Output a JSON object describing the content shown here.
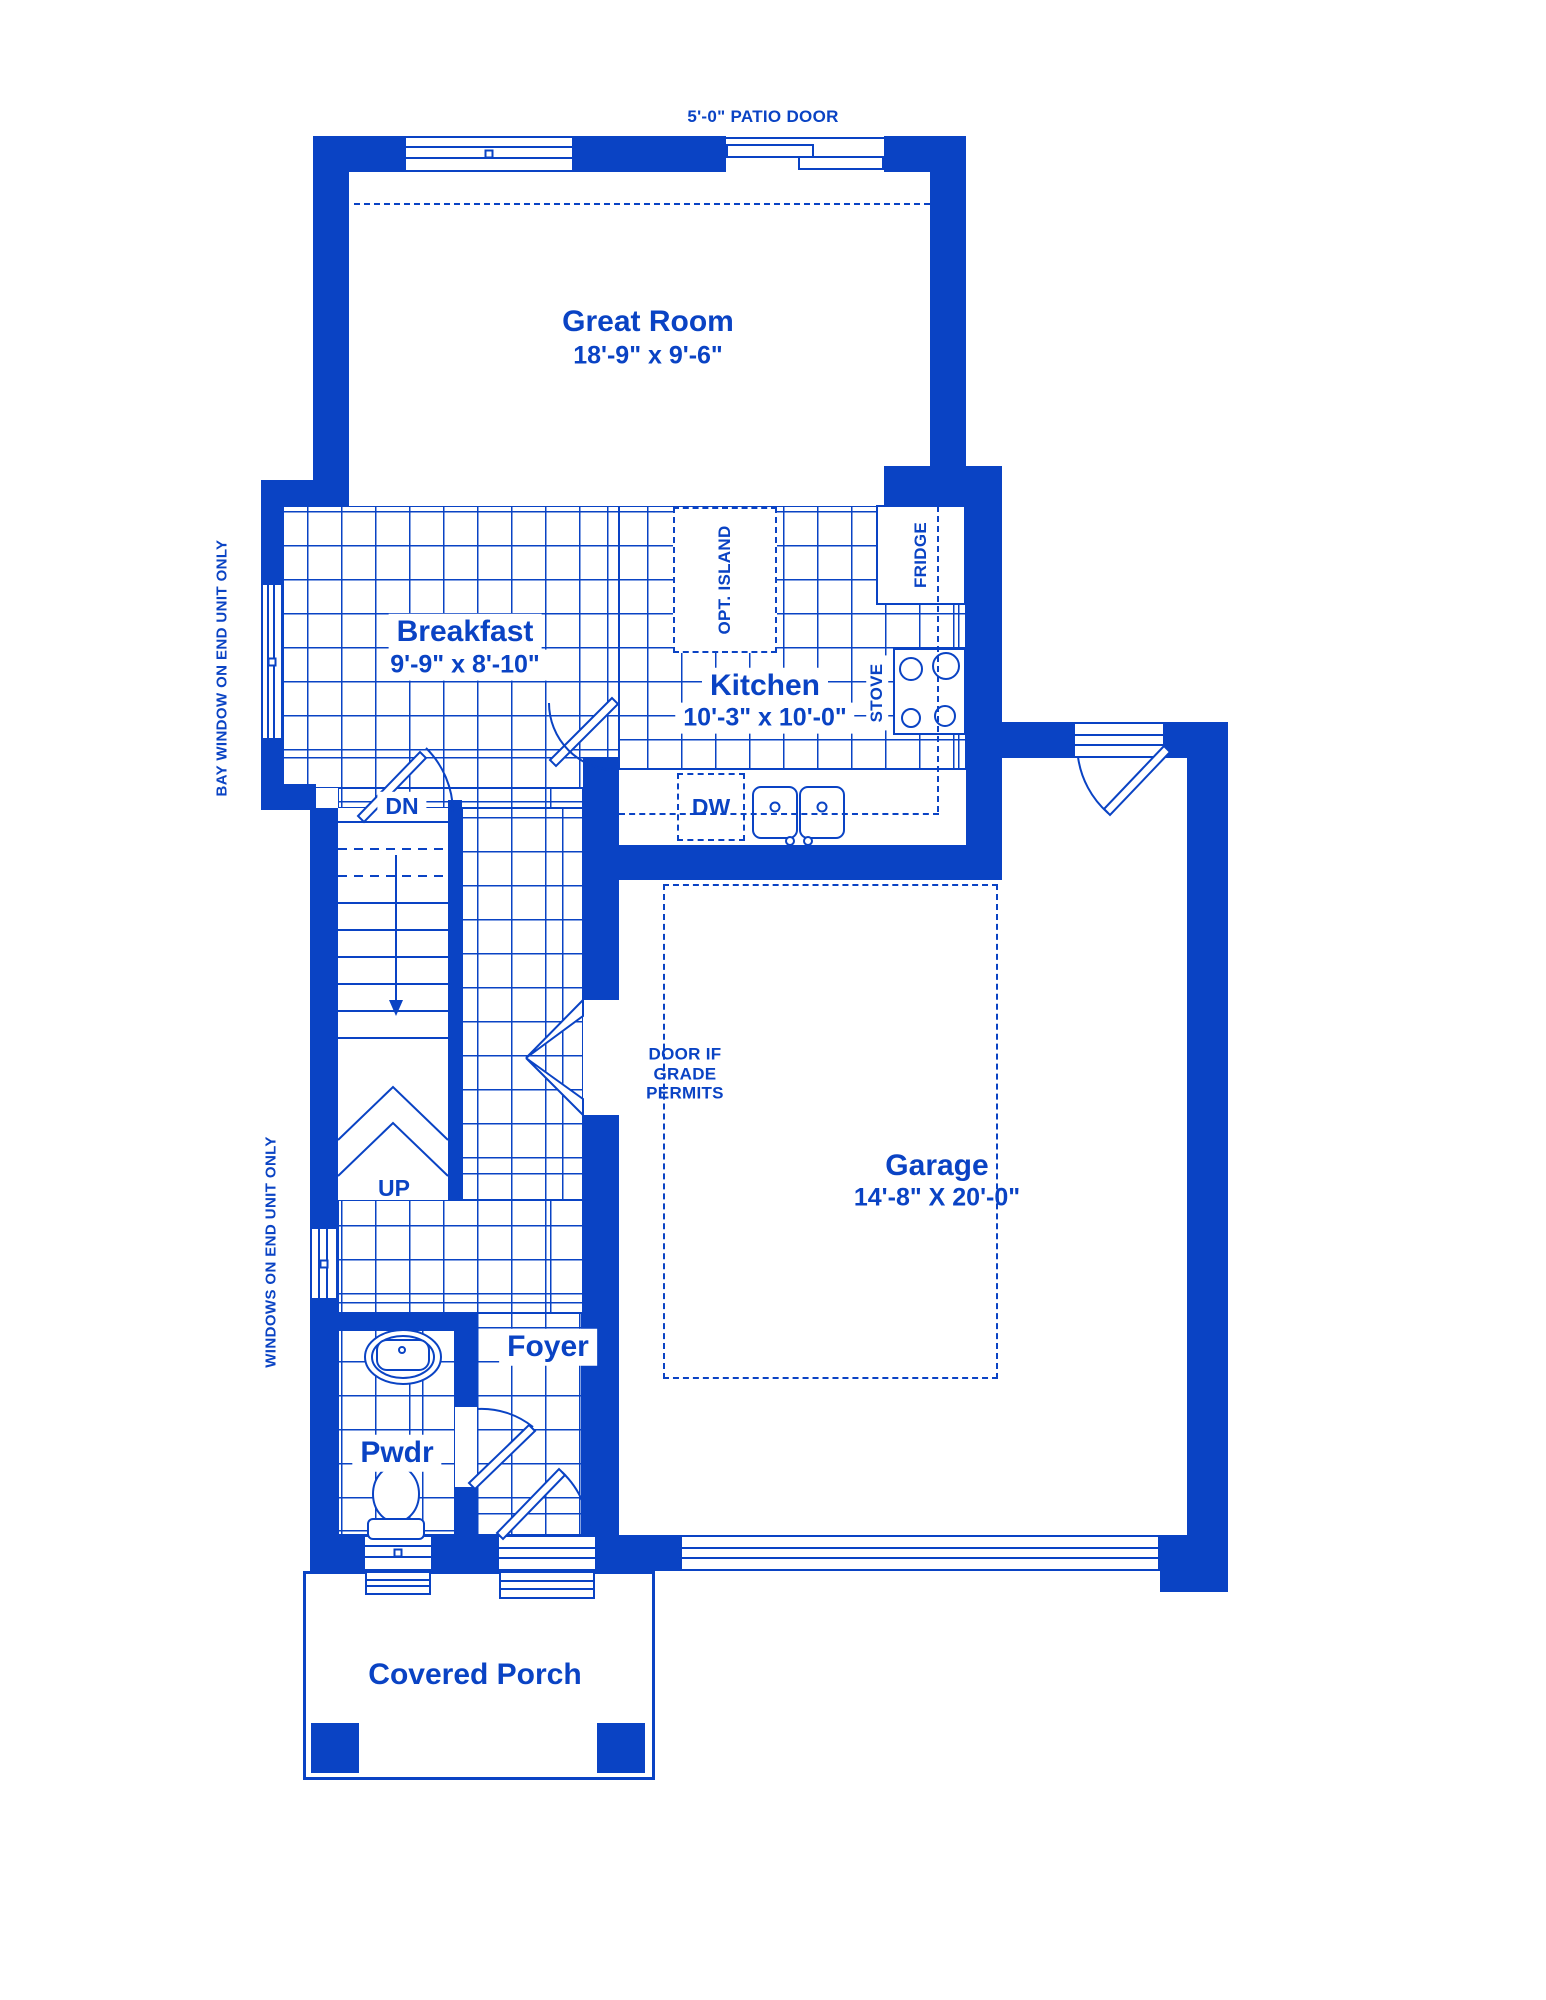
{
  "colors": {
    "ink": "#0a43c4",
    "background": "#ffffff"
  },
  "labels": {
    "patio_door": "5'-0\" PATIO DOOR",
    "great_room_name": "Great Room",
    "great_room_dims": "18'-9\" x 9'-6\"",
    "breakfast_name": "Breakfast",
    "breakfast_dims": "9'-9\" x 8'-10\"",
    "kitchen_name": "Kitchen",
    "kitchen_dims": "10'-3\" x 10'-0\"",
    "garage_name": "Garage",
    "garage_dims": "14'-8\" X 20'-0\"",
    "foyer": "Foyer",
    "pwdr": "Pwdr",
    "covered_porch": "Covered Porch",
    "opt_island": "OPT. ISLAND",
    "fridge": "FRIDGE",
    "stove": "STOVE",
    "dw": "DW",
    "dn": "DN",
    "up": "UP",
    "door_grade": "DOOR IF\nGRADE\nPERMITS",
    "bay_note": "BAY WINDOW ON END UNIT ONLY",
    "windows_note": "WINDOWS ON END UNIT ONLY"
  }
}
